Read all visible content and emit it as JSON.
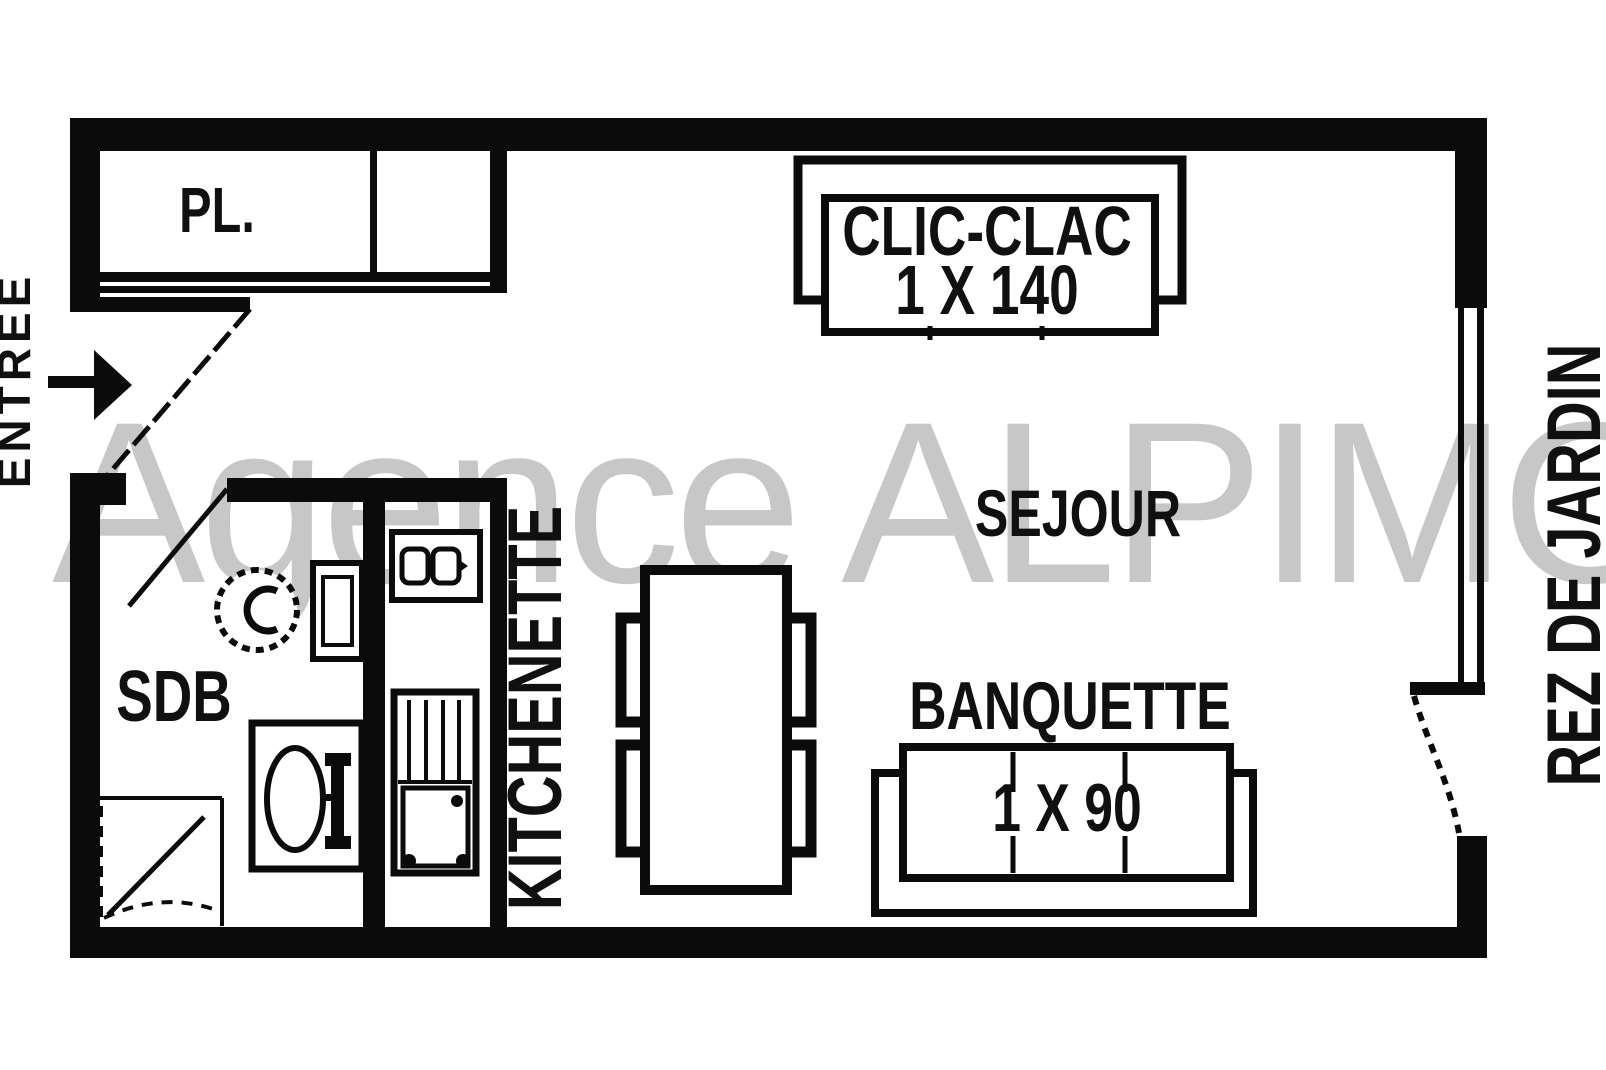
{
  "plan": {
    "watermark": "Agence ALPIMO",
    "rooms": {
      "closet": {
        "label": "PL."
      },
      "bathroom": {
        "label": "SDB"
      },
      "kitchen": {
        "label": "KITCHENETTE"
      },
      "living": {
        "label": "SEJOUR"
      }
    },
    "furniture": {
      "sofa_bed": {
        "label": "CLIC-CLAC",
        "size": "1 X 140"
      },
      "bench": {
        "label": "BANQUETTE",
        "size": "1 X 90"
      }
    },
    "annotations": {
      "entrance": "ENTREE",
      "level": "REZ DE JARDIN"
    },
    "colors": {
      "wall": "#0b0b0b",
      "background": "#ffffff",
      "watermark": "#c7c7c7"
    }
  }
}
